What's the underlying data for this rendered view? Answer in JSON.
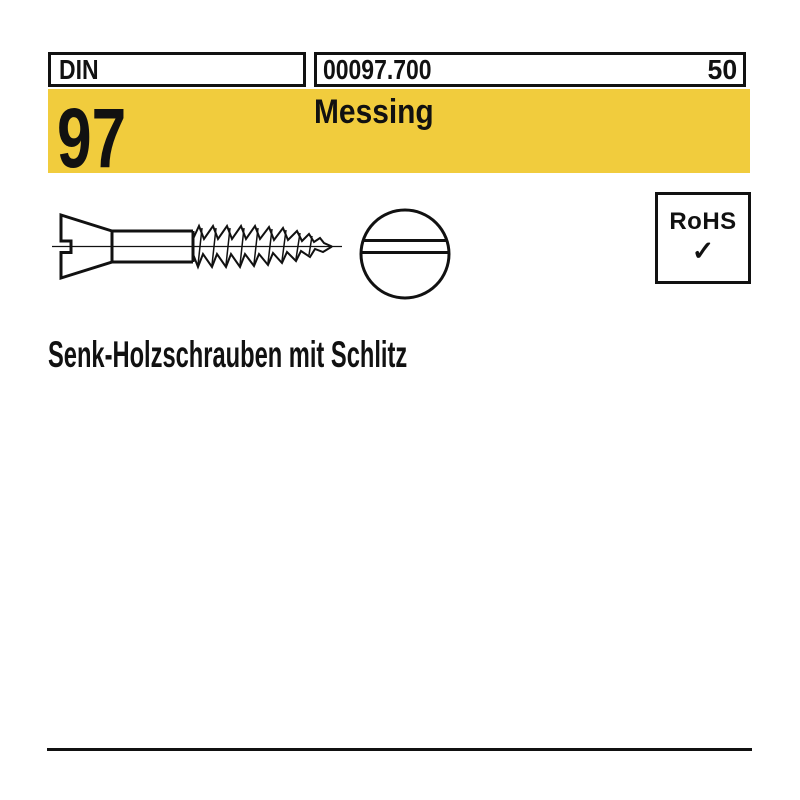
{
  "header": {
    "din_label": "DIN",
    "article_number": "00097.700",
    "page_number": "50"
  },
  "banner": {
    "standard_number": "97",
    "material": "Messing",
    "background_color": "#F1CC3D"
  },
  "drawing": {
    "side_view": "slotted countersunk wood screw, side view",
    "front_view": "screw head front view with slot",
    "rohs": {
      "label": "RoHS",
      "check_icon": "✓"
    }
  },
  "title": {
    "text": "Senk-Holzschrauben mit Schlitz"
  },
  "colors": {
    "ink": "#111111",
    "paper": "#ffffff"
  }
}
